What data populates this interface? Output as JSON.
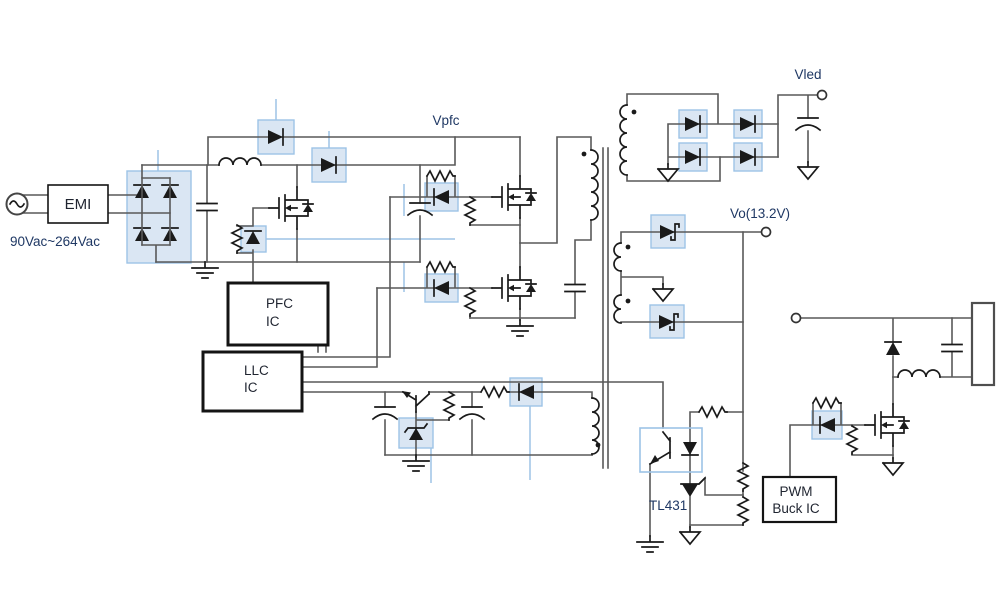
{
  "diagram": {
    "type": "power-supply-schematic",
    "labels": {
      "input_range": "90Vac~264Vac",
      "vpfc": "Vpfc",
      "vled": "Vled",
      "vo": "Vo(13.2V)",
      "tl431": "TL431"
    },
    "blocks": {
      "emi": "EMI",
      "pfc_ic": [
        "PFC",
        "IC"
      ],
      "llc_ic": [
        "LLC",
        "IC"
      ],
      "pwm_buck_ic": [
        "PWM",
        "Buck IC"
      ]
    },
    "colors": {
      "background": "#ffffff",
      "wire": "#595959",
      "component": "#1a1a1a",
      "highlight_fill": "#dae6f3",
      "highlight_stroke": "#9dc3e6",
      "leader_line": "#9dc3e6",
      "net_label": "#1f3864",
      "block_label": "#1f2430"
    }
  }
}
